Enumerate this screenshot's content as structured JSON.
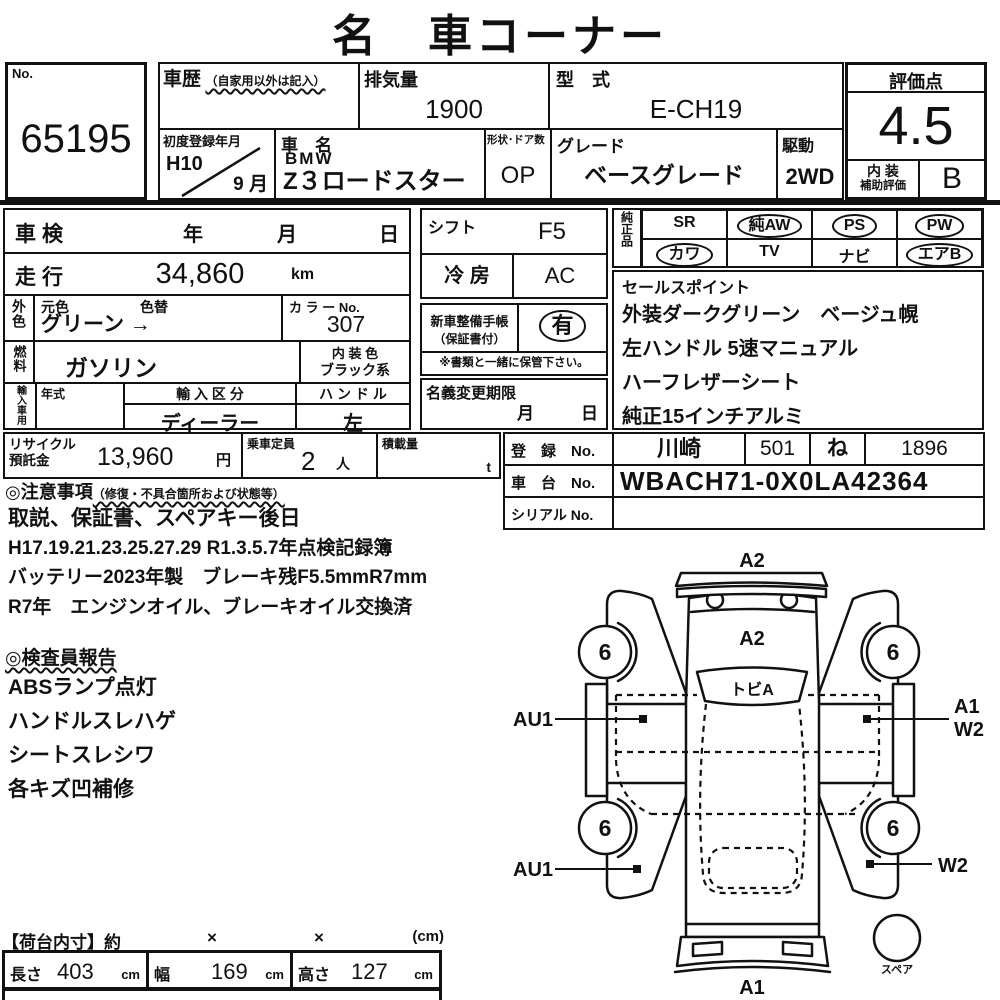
{
  "title": "名　車コーナー",
  "no_box": {
    "label": "No.",
    "value": "65195"
  },
  "top": {
    "shareki_label": "車歴",
    "shareki_note": "（自家用以外は記入）",
    "haikiryo_label": "排気量",
    "haikiryo_value": "1900",
    "katashiki_label": "型　式",
    "katashiki_value": "E-CH19",
    "first_reg_label": "初度登録年月",
    "first_reg_year": "H10",
    "first_reg_month": "9 月",
    "car_name_label": "車　名",
    "car_maker": "BMW",
    "car_model": "Z３ロードスター",
    "shape_label": "形状･ドア数",
    "shape_value": "OP",
    "grade_label": "グレード",
    "grade_value": "ベースグレード",
    "drive_label": "駆動",
    "drive_value": "2WD",
    "score_label": "評価点",
    "score_value": "4.5",
    "interior_label_1": "内 装",
    "interior_label_2": "補助評価",
    "interior_value": "B"
  },
  "left_table": {
    "shaken_label": "車検",
    "year": "年",
    "month": "月",
    "day": "日",
    "soko_label": "走行",
    "soko_value": "34,860",
    "soko_unit": "km",
    "gaishoku_label": "外色",
    "motoiro_label": "元色",
    "iroga_label": "色替",
    "color_value": "グリーン →",
    "color_no_label": "カ ラ ー No.",
    "color_no_value": "307",
    "fuel_label": "燃料",
    "fuel_value": "ガソリン",
    "naiso_label": "内 装 色",
    "naiso_value": "ブラック系",
    "import_label": "輸入車用",
    "nenshiki_label": "年式",
    "kubun_label": "輸 入 区 分",
    "kubun_value": "ディーラー",
    "handle_label": "ハ ン ド ル",
    "handle_value": "左"
  },
  "mid": {
    "shift_label": "シフト",
    "shift_value": "F5",
    "aircon_label": "冷 房",
    "aircon_value": "AC",
    "techo_label_1": "新車整備手帳",
    "techo_label_2": "（保証書付）",
    "techo_value": "有",
    "note": "※書類と一緒に保管下さい。",
    "meigi_label": "名義変更期限",
    "meigi_month": "月",
    "meigi_day": "日"
  },
  "junsei": {
    "label": "純正品",
    "items": [
      {
        "label": "SR",
        "circled": false
      },
      {
        "label": "純AW",
        "circled": true
      },
      {
        "label": "PS",
        "circled": true
      },
      {
        "label": "PW",
        "circled": true
      },
      {
        "label": "カワ",
        "circled": true
      },
      {
        "label": "TV",
        "circled": false
      },
      {
        "label": "ナビ",
        "circled": false
      },
      {
        "label": "エアB",
        "circled": true
      }
    ]
  },
  "sales": {
    "label": "セールスポイント",
    "lines": [
      "外装ダークグリーン　ベージュ幌",
      "左ハンドル 5速マニュアル",
      "ハーフレザーシート",
      "純正15インチアルミ"
    ]
  },
  "recycle": {
    "label_1": "リサイクル",
    "label_2": "預託金",
    "value": "13,960",
    "unit": "円",
    "capacity_label": "乗車定員",
    "capacity_value": "2",
    "capacity_unit": "人",
    "load_label": "積載量",
    "load_unit": "t"
  },
  "registration": {
    "toroku_label": "登　録　No.",
    "toroku_area": "川崎",
    "toroku_class": "501",
    "toroku_kana": "ね",
    "toroku_num": "1896",
    "shadai_label": "車　台　No.",
    "shadai_value": "WBACH71-0X0LA42364",
    "serial_label": "シリアル No.",
    "serial_value": ""
  },
  "notes": {
    "heading": "◎注意事項",
    "heading_note": "（修復・不具合箇所および状態等）",
    "lines": [
      "取説、保証書、スペアキー後日",
      "H17.19.21.23.25.27.29 R1.3.5.7年点検記録簿",
      "バッテリー2023年製　ブレーキ残F5.5mmR7mm",
      "R7年　エンジンオイル、ブレーキオイル交換済"
    ]
  },
  "inspector": {
    "heading": "◎検査員報告",
    "lines": [
      "ABSランプ点灯",
      "ハンドルスレハゲ",
      "シートスレシワ",
      "各キズ凹補修"
    ]
  },
  "cargo": {
    "heading": "【荷台内寸】約",
    "x1": "×",
    "x2": "×",
    "unit": "(cm)",
    "cells": [
      {
        "label": "長さ",
        "value": "403",
        "unit": "cm"
      },
      {
        "label": "幅",
        "value": "169",
        "unit": "cm"
      },
      {
        "label": "高さ",
        "value": "127",
        "unit": "cm"
      }
    ]
  },
  "diagram": {
    "rear_label": "A2",
    "hood_label": "A2",
    "windshield_label": "トビA",
    "tire": "6",
    "left_top_label": "AU1",
    "left_bottom_label": "AU1",
    "right_top_label_1": "A1",
    "right_top_label_2": "W2",
    "right_bottom_label": "W2",
    "front_label": "A1",
    "spare_label": "スペア"
  }
}
